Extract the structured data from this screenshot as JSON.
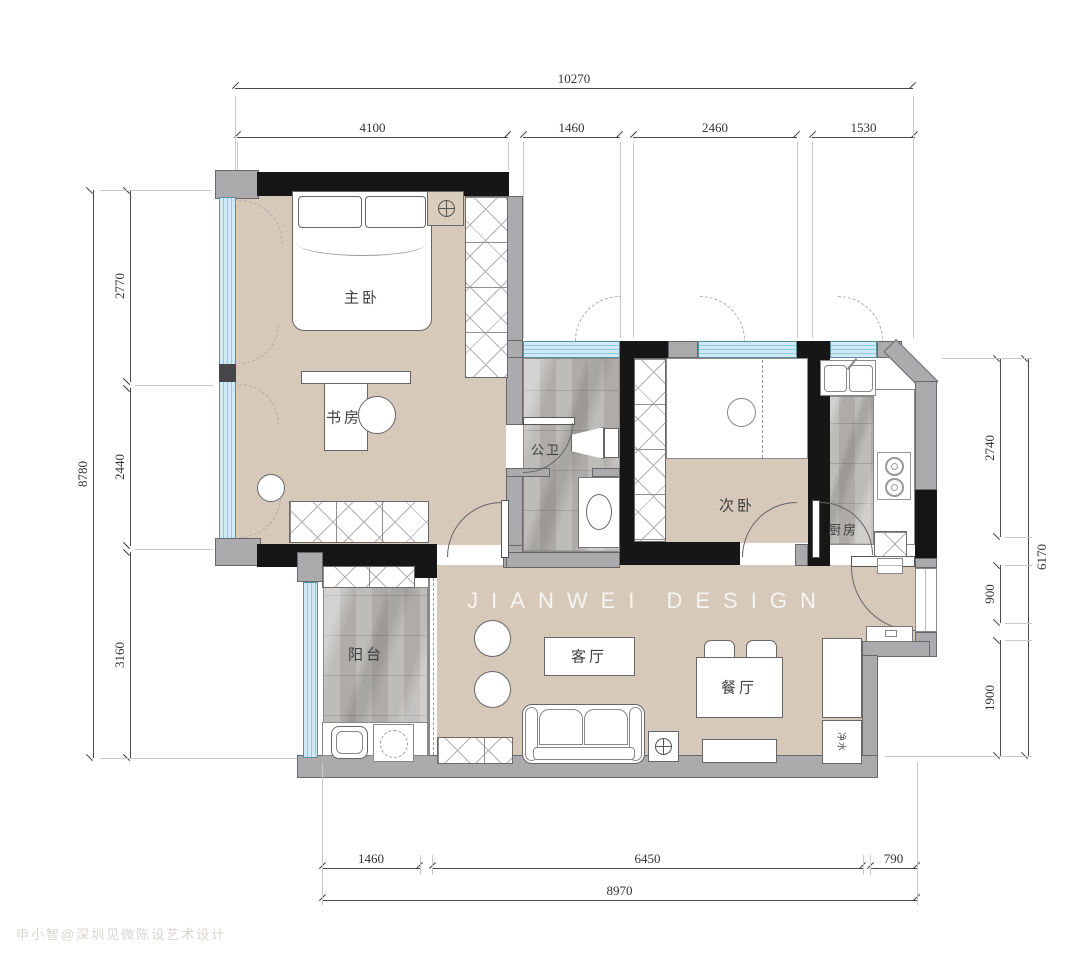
{
  "document": {
    "type": "residential floor plan"
  },
  "watermark": {
    "brand": "JIANWEI DESIGN",
    "credit": "申小智@深圳见微陈设艺术设计"
  },
  "rooms": {
    "master_bedroom": "主卧",
    "study": "书房",
    "bathroom": "公卫",
    "second_bedroom": "次卧",
    "kitchen": "厨房",
    "balcony": "阳台",
    "living_room": "客厅",
    "dining_room": "餐厅"
  },
  "labels": {
    "water_cabinet": "净水"
  },
  "dimensions": {
    "top": {
      "total": "10270",
      "segments": [
        "4100",
        "1460",
        "2460",
        "1530"
      ]
    },
    "left": {
      "total": "8780",
      "segments": [
        "2770",
        "2440",
        "3160"
      ]
    },
    "right": {
      "total": "6170",
      "segments": [
        "2740",
        "900",
        "1900"
      ]
    },
    "bottom": {
      "total": "8970",
      "segments": [
        "1460",
        "6450",
        "790"
      ]
    }
  },
  "colors": {
    "floor_tan": "#d6c9b9",
    "wall_gray": "#ababad",
    "wall_black": "#161616",
    "window_blue": "#cfeaf5",
    "marble_gray": "#b7b4b1"
  }
}
